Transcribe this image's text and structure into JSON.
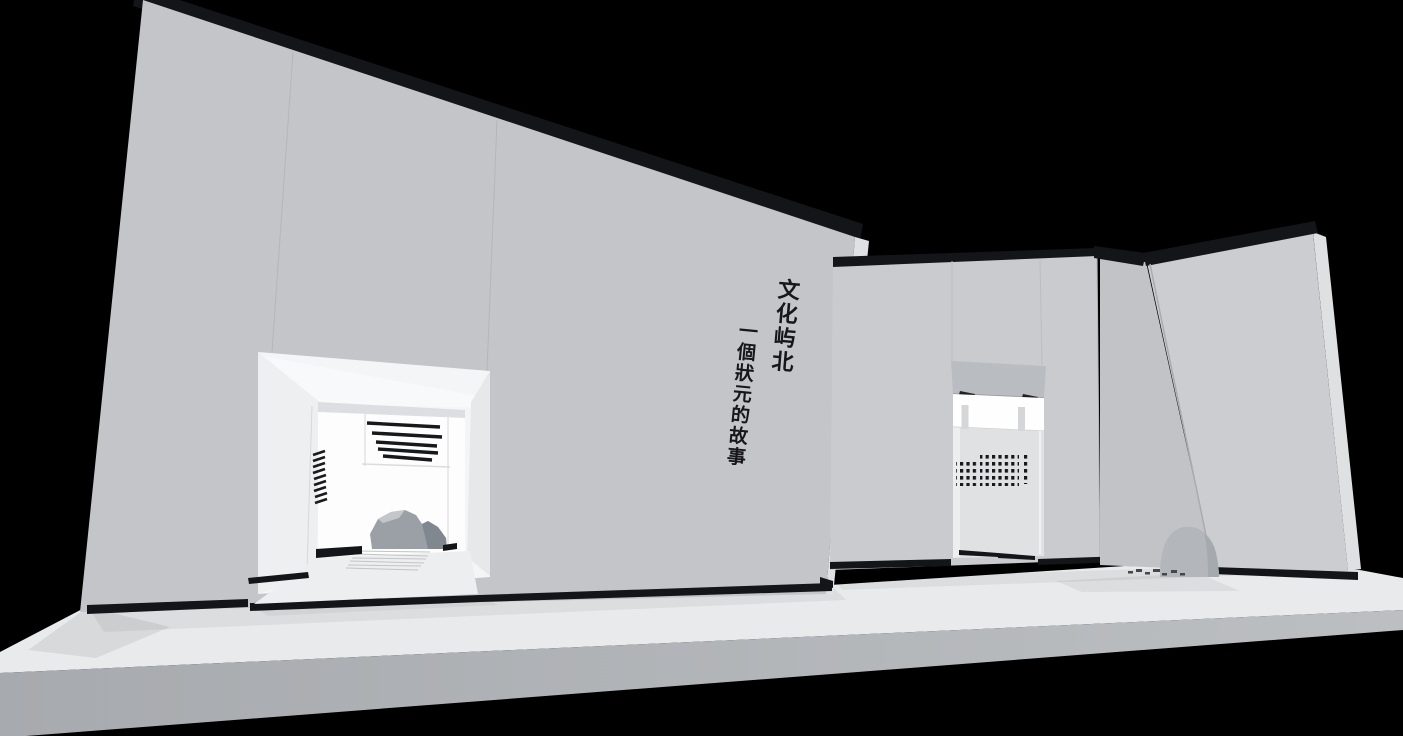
{
  "scene": {
    "description": "Grayscale 3D architectural rendering of an exhibition hall on a raised platform against a black background: a large angled wall with vertical brush calligraphy, a doorway revealing louver slats and rocks, a recessed alcove with hanging signboard and perforated panel, and a leaning wall panel with a boulder at its base",
    "style": "monochrome concept render"
  },
  "wall_text": {
    "title": "文化屿北",
    "subtitle": "一個狀元的故事",
    "writing_direction": "vertical",
    "ink_color": "#17171a"
  },
  "colors": {
    "background": "#000000",
    "wall": "#c3c5c9",
    "wall_middle": "#c9cbcf",
    "wall_right": "#cbcdd1",
    "panel_dark": "#c1c3c7",
    "platform_top": "#e9eaec",
    "platform_front": "#aeb1b4",
    "edge_cap_black": "#141518",
    "interior_white": "#fdfdfe",
    "signboard": "#b9bdc1",
    "boulder": "#b3b7bb",
    "rock_dark": "#81878e"
  }
}
